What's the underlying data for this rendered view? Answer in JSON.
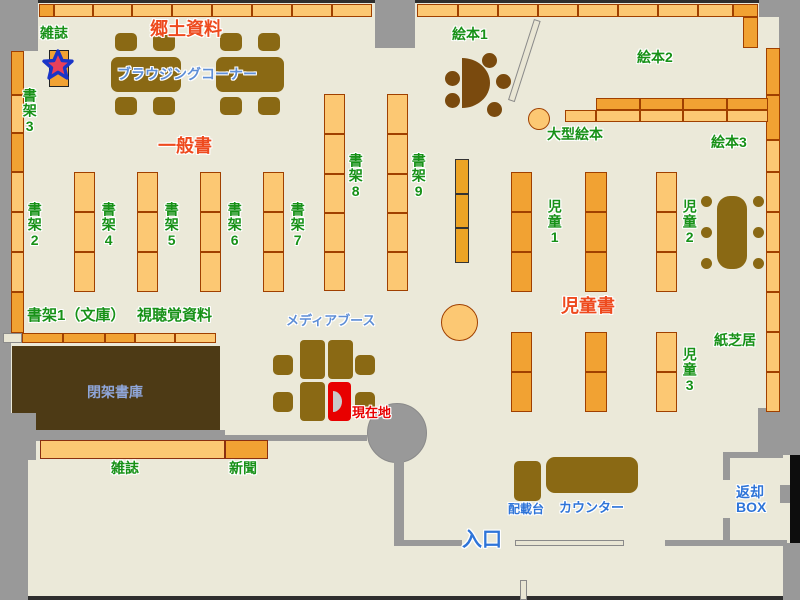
{
  "map_type": "library-floor-map",
  "labels": {
    "magazines_top": "雑誌",
    "local_materials": "郷土資料",
    "browsing_corner": "ブラウジングコーナー",
    "shelf3": "書架3",
    "general_books": "一般書",
    "shelf2": "書架2",
    "shelf4": "書架4",
    "shelf5": "書架5",
    "shelf6": "書架6",
    "shelf7": "書架7",
    "shelf8": "書架8",
    "shelf9": "書架9",
    "picture_books1": "絵本1",
    "picture_books2": "絵本2",
    "picture_books3": "絵本3",
    "large_picture_books": "大型絵本",
    "children1": "児童1",
    "children2": "児童2",
    "children3": "児童3",
    "children_books": "児童書",
    "kamishibai": "紙芝居",
    "shelf1_bunko": "書架1（文庫）",
    "audiovisual": "視聴覚資料",
    "media_booth": "メディアブース",
    "closed_stacks": "閉架書庫",
    "current_location": "現在地",
    "magazines_bottom": "雑誌",
    "newspapers": "新聞",
    "distribution_desk": "配載台",
    "counter": "カウンター",
    "entrance": "入口",
    "return_box": "返却\nBOX"
  },
  "colors": {
    "floor": "#ebe9d9",
    "wall_gray": "#999999",
    "shelf_light": "#fcc873",
    "shelf_dark": "#f1a233",
    "shelf_border": "#a04000",
    "furniture_brown": "#8a6914",
    "furniture_dark_brown": "#7a4a0e",
    "closed_stacks_brown": "#4d3a15",
    "label_green": "#179117",
    "label_red": "#ee4a1e",
    "label_blue": "#5e8ed6",
    "label_light_blue": "#8fa6d9",
    "current_location_red": "#e80000",
    "star_red": "#e8405a",
    "star_outline_blue": "#1a35c8"
  }
}
